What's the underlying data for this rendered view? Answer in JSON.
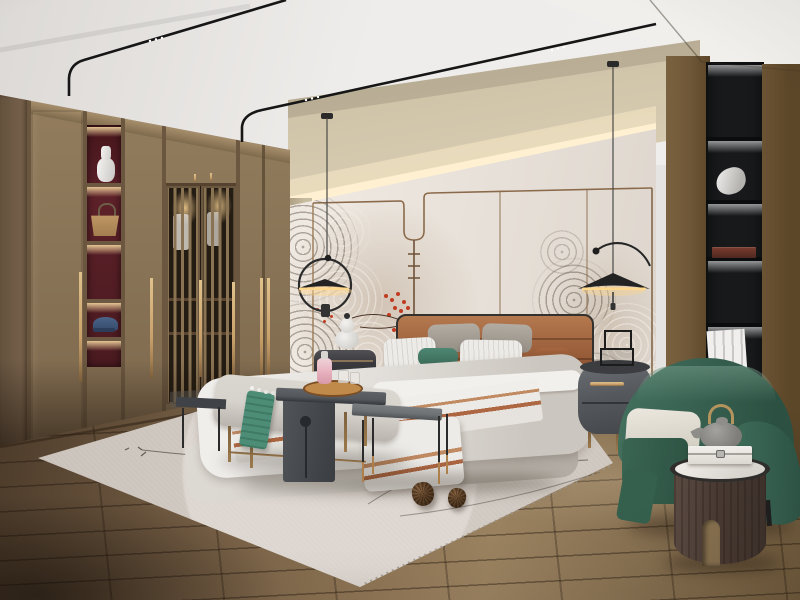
{
  "scene": {
    "description": "3D interior render of a modern Chinese style bedroom, no visible text",
    "objects": [
      {
        "name": "ceiling-track-lights",
        "desc": "two thin black magnetic track rails with tiny white spotlights, curving down the cove"
      },
      {
        "name": "cove-lighting",
        "desc": "warm LED strip glowing above headboard wall panels"
      },
      {
        "name": "headboard-wall",
        "desc": "off-white panels with bronze trim line that dips in a U shape, decorated with gray swirl wave mural and red blossoms"
      },
      {
        "name": "wardrobe",
        "desc": "full-height walnut wardrobe with lattice slat doors, long brass handles and lit display niches holding a white vase, a tan handbag and a blue cap"
      },
      {
        "name": "bookcase",
        "desc": "tall black recessed shelf column with LED lit shelves holding a white sculpture, a dark red box and white books"
      },
      {
        "name": "bed",
        "desc": "upholstered bed with caramel leather headboard, gray and white pillows, teal accent pillow, white duvet with terracotta striped throw"
      },
      {
        "name": "nightstands",
        "desc": "dark gray round nightstands; left one with white gourd lamp, right one with brass handle and miniature trolley decor"
      },
      {
        "name": "pendant-lights",
        "desc": "two black flat-cone pendants on sculptural arc arms with warm underglow"
      },
      {
        "name": "bench-set",
        "desc": "light gray bench with teal throw, dark gray waterfall side table, wooden tray with pink decanter and glasses, plus slim gray side table"
      },
      {
        "name": "armchair",
        "desc": "teal green barrel armchair with cream cushion"
      },
      {
        "name": "round-side-table",
        "desc": "dark wood cylinder table with marble top holding a gray teapot and a white box"
      },
      {
        "name": "rug",
        "desc": "light gray rug with arc motif, thin dark branch lines and two pinecones"
      },
      {
        "name": "floor",
        "desc": "brown wood plank floor"
      }
    ]
  },
  "palette": {
    "ceiling_a": "#dcd9d6",
    "ceiling_b": "#efedeb",
    "soffit": "#f1efec",
    "beige_a": "#c3b79c",
    "beige_b": "#ddd2b8",
    "glow": "#fff3d6",
    "panel_a": "#efe9e2",
    "panel_b": "#ddd5cc",
    "trim": "#8a6a4a",
    "mural_dark": "#64584c",
    "mural_light": "#faf6f0",
    "blossom": "#c13b20",
    "wood": "#8a7558",
    "wood_dark": "#6b5740",
    "wood_side": "#75604a",
    "niche_red": "#5d2129",
    "brass": "#c9a06a",
    "track": "#161616",
    "wallwood_a": "#6e5638",
    "wallwood_b": "#523f24",
    "case_black": "#17191b",
    "leather_a": "#b5794f",
    "leather_b": "#8a4f2f",
    "headboard_frame": "#33322f",
    "bedding_a": "#f0eeeb",
    "bedding_b": "#cbc6bf",
    "stripe_a": "#c08a62",
    "stripe_b": "#ad6742",
    "teal": "#47806e",
    "pillow_gray": "#a9a29a",
    "bed_base": "#d6d2cc",
    "bench": "#d6d2cc",
    "ctable_a": "#55585c",
    "ctable_b": "#3a3d41",
    "tray": "#a06a34",
    "bottle_pink": "#e8b4c0",
    "table_top": "#6e7174",
    "rug_a": "#c6beb6",
    "rug_b": "#ddd6d0",
    "rug_line": "#45403a",
    "floor_a": "#8a7152",
    "floor_b": "#4c3b2a",
    "floor_c": "#9a8260",
    "chair_a": "#44715f",
    "chair_b": "#2c5142",
    "cushion": "#ece8df",
    "cyl_a": "#5a4a42",
    "cyl_b": "#3e322c",
    "marble": "#f0ede8",
    "night_r": "#55585c",
    "night_l": "#3a3a3e",
    "lamp_white": "#f2f1ef",
    "pine": "#5f4328"
  }
}
